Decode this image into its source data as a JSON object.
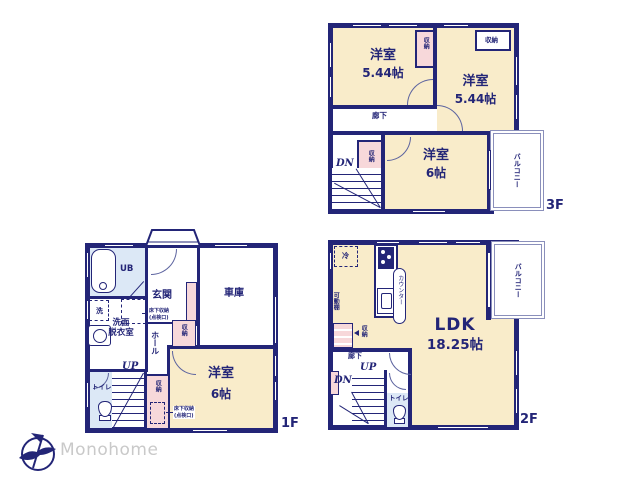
{
  "colors": {
    "wall": "#232577",
    "room_cream": "#f9ecca",
    "closet_pink": "#f7d8da",
    "wet_blue": "#dce8f6",
    "balcony_line": "#8a8fbb",
    "text": "#232577",
    "logo_gray": "#c9c9c9"
  },
  "floor3": {
    "label": "3F",
    "room_a": "洋室",
    "room_a_size": "5.44帖",
    "room_b": "洋室",
    "room_b_size": "5.44帖",
    "room_c": "洋室",
    "room_c_size": "6帖",
    "closet": "収納",
    "corridor": "廊下",
    "balcony": "バルコニー",
    "dn": "DN"
  },
  "floor2": {
    "label": "2F",
    "ldk": "LDK",
    "ldk_size": "18.25帖",
    "balcony": "バルコニー",
    "fridge": "冷",
    "counter": "カウンター",
    "shelf": "可動棚",
    "closet": "収納",
    "corridor": "廊下",
    "up": "UP",
    "dn": "DN",
    "toilet": "トイレ"
  },
  "floor1": {
    "label": "1F",
    "ub": "UB",
    "washer": "洗",
    "washroom1": "洗面",
    "washroom2": "脱衣室",
    "entrance": "玄関",
    "garage": "車庫",
    "hall": "ホール",
    "toilet": "トイレ",
    "up": "UP",
    "closet": "収納",
    "underfloor1": "床下収納",
    "underfloor2": "(点検口)",
    "room": "洋室",
    "room_size": "6帖"
  },
  "logo": {
    "company": "Monohome"
  }
}
